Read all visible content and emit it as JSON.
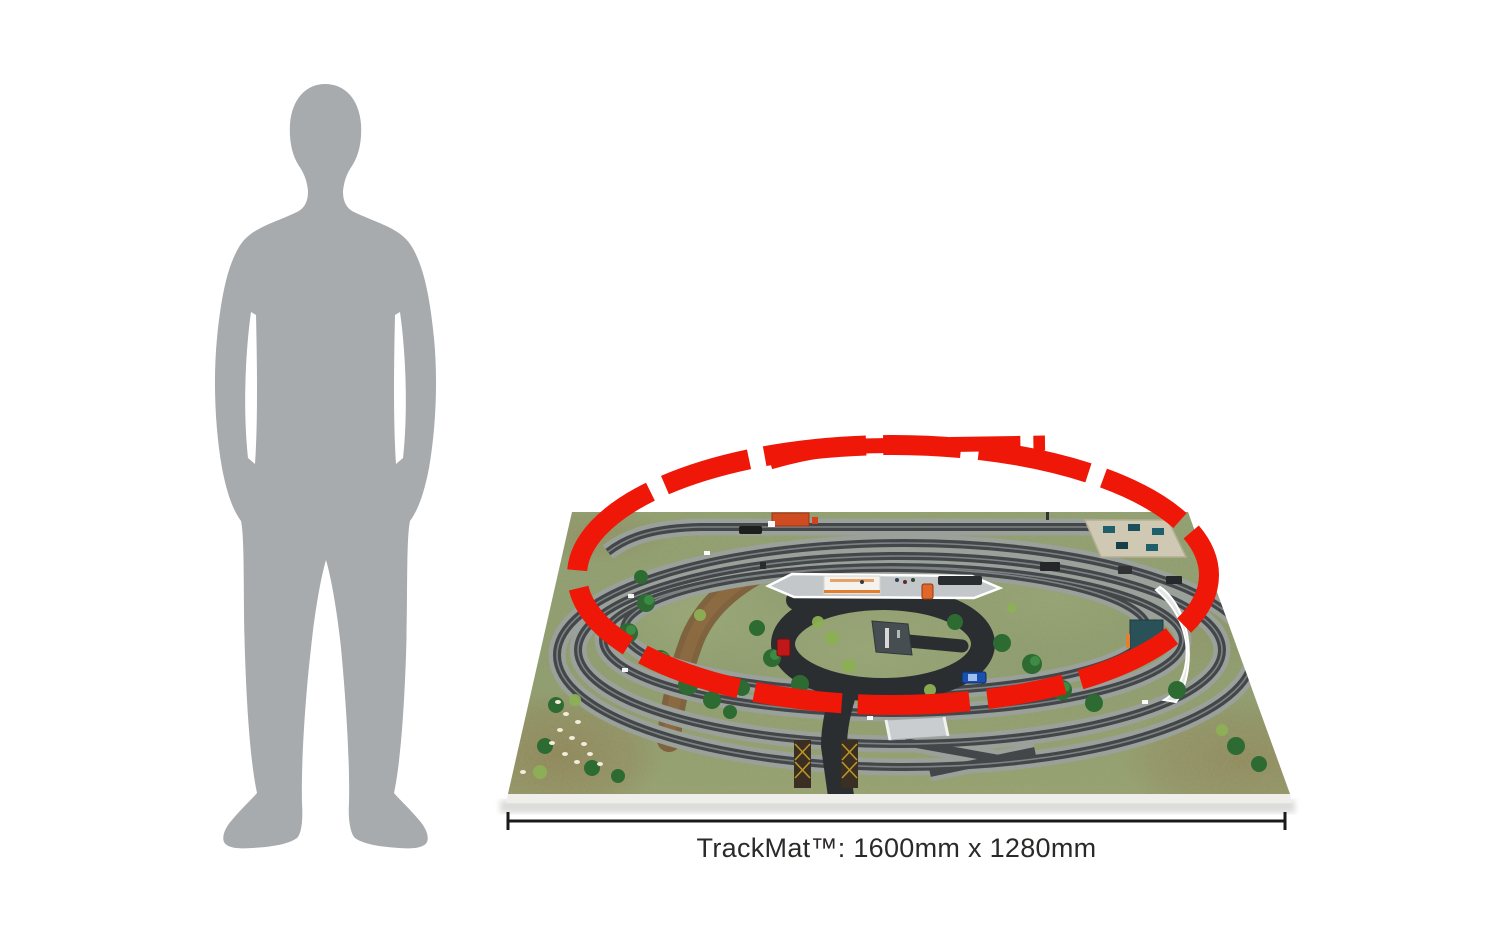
{
  "page": {
    "background": "#ffffff",
    "description_visible_elements": {
      "scale_figure": "grey adult man silhouette",
      "product_image": "model railway track mat seen from above with oval train tracks, roads, station platform and scenery",
      "overlay": "red dashed oval track plan with top siding"
    }
  },
  "dimension": {
    "label": "TrackMat™: 1600mm x 1280mm"
  },
  "colors": {
    "page_bg": "#ffffff",
    "highlight_red": "#ee1708",
    "silhouette_grey": "#a7abae",
    "mat_green": "#8d9b6d",
    "mat_green_light": "#9cab7c",
    "mat_brown": "#93865c",
    "ballast_grey": "#9aa09a",
    "rail_dark": "#43474a",
    "road_black": "#2b2e31",
    "platform_grey": "#c3c7c9",
    "label_text": "#2b2a28",
    "dimension_line": "#1a1a1a"
  }
}
